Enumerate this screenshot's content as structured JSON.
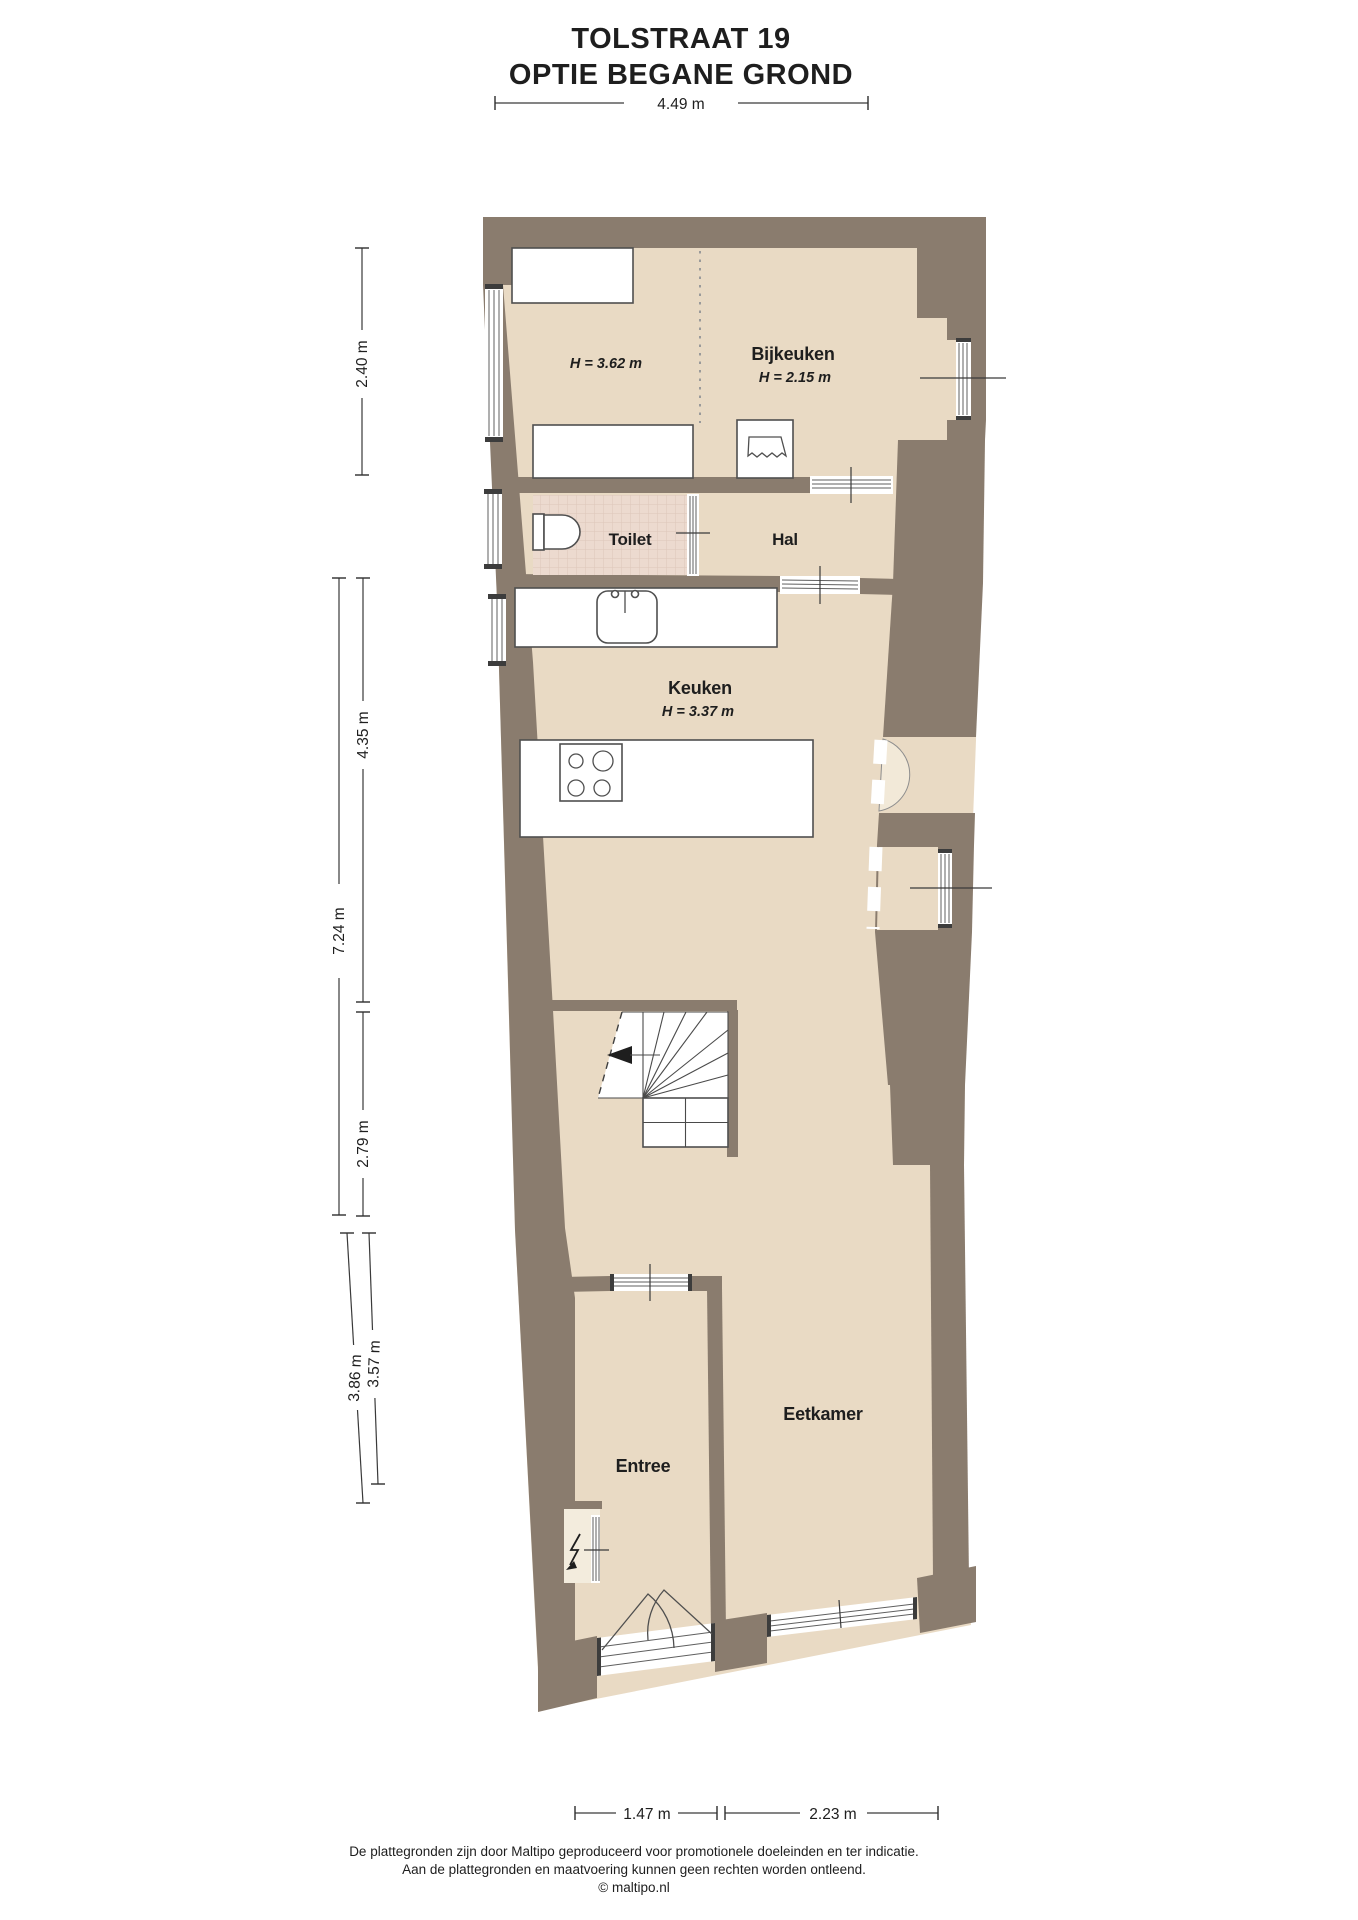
{
  "title": {
    "line1": "TOLSTRAAT 19",
    "line2": "OPTIE BEGANE GROND"
  },
  "rooms": {
    "utility": {
      "height": "H = 3.62 m"
    },
    "bijkeuken": {
      "name": "Bijkeuken",
      "height": "H = 2.15 m"
    },
    "toilet": {
      "name": "Toilet"
    },
    "hal": {
      "name": "Hal"
    },
    "keuken": {
      "name": "Keuken",
      "height": "H = 3.37 m"
    },
    "entree": {
      "name": "Entree"
    },
    "eetkamer": {
      "name": "Eetkamer"
    }
  },
  "dimensions": {
    "top": "4.49 m",
    "upper_left": "2.40 m",
    "left_outer": "7.24 m",
    "left_inner_upper": "4.35 m",
    "left_inner_lower": "2.79 m",
    "lower_left_outer": "3.86 m",
    "lower_left_inner": "3.57 m",
    "bottom_left": "1.47 m",
    "bottom_right": "2.23 m"
  },
  "footer": {
    "line1": "De plattegronden zijn door Maltipo geproduceerd voor promotionele doeleinden en ter indicatie.",
    "line2": "Aan de plattegronden en maatvoering kunnen geen rechten worden ontleend.",
    "copyright": "© maltipo.nl"
  },
  "colors": {
    "wall": "#8a7c6e",
    "floor": "#e9dac4",
    "toilet_tile": "#ecdacf",
    "swing_arc": "#f2e9d8",
    "dimension_line": "#3a3a3a"
  }
}
